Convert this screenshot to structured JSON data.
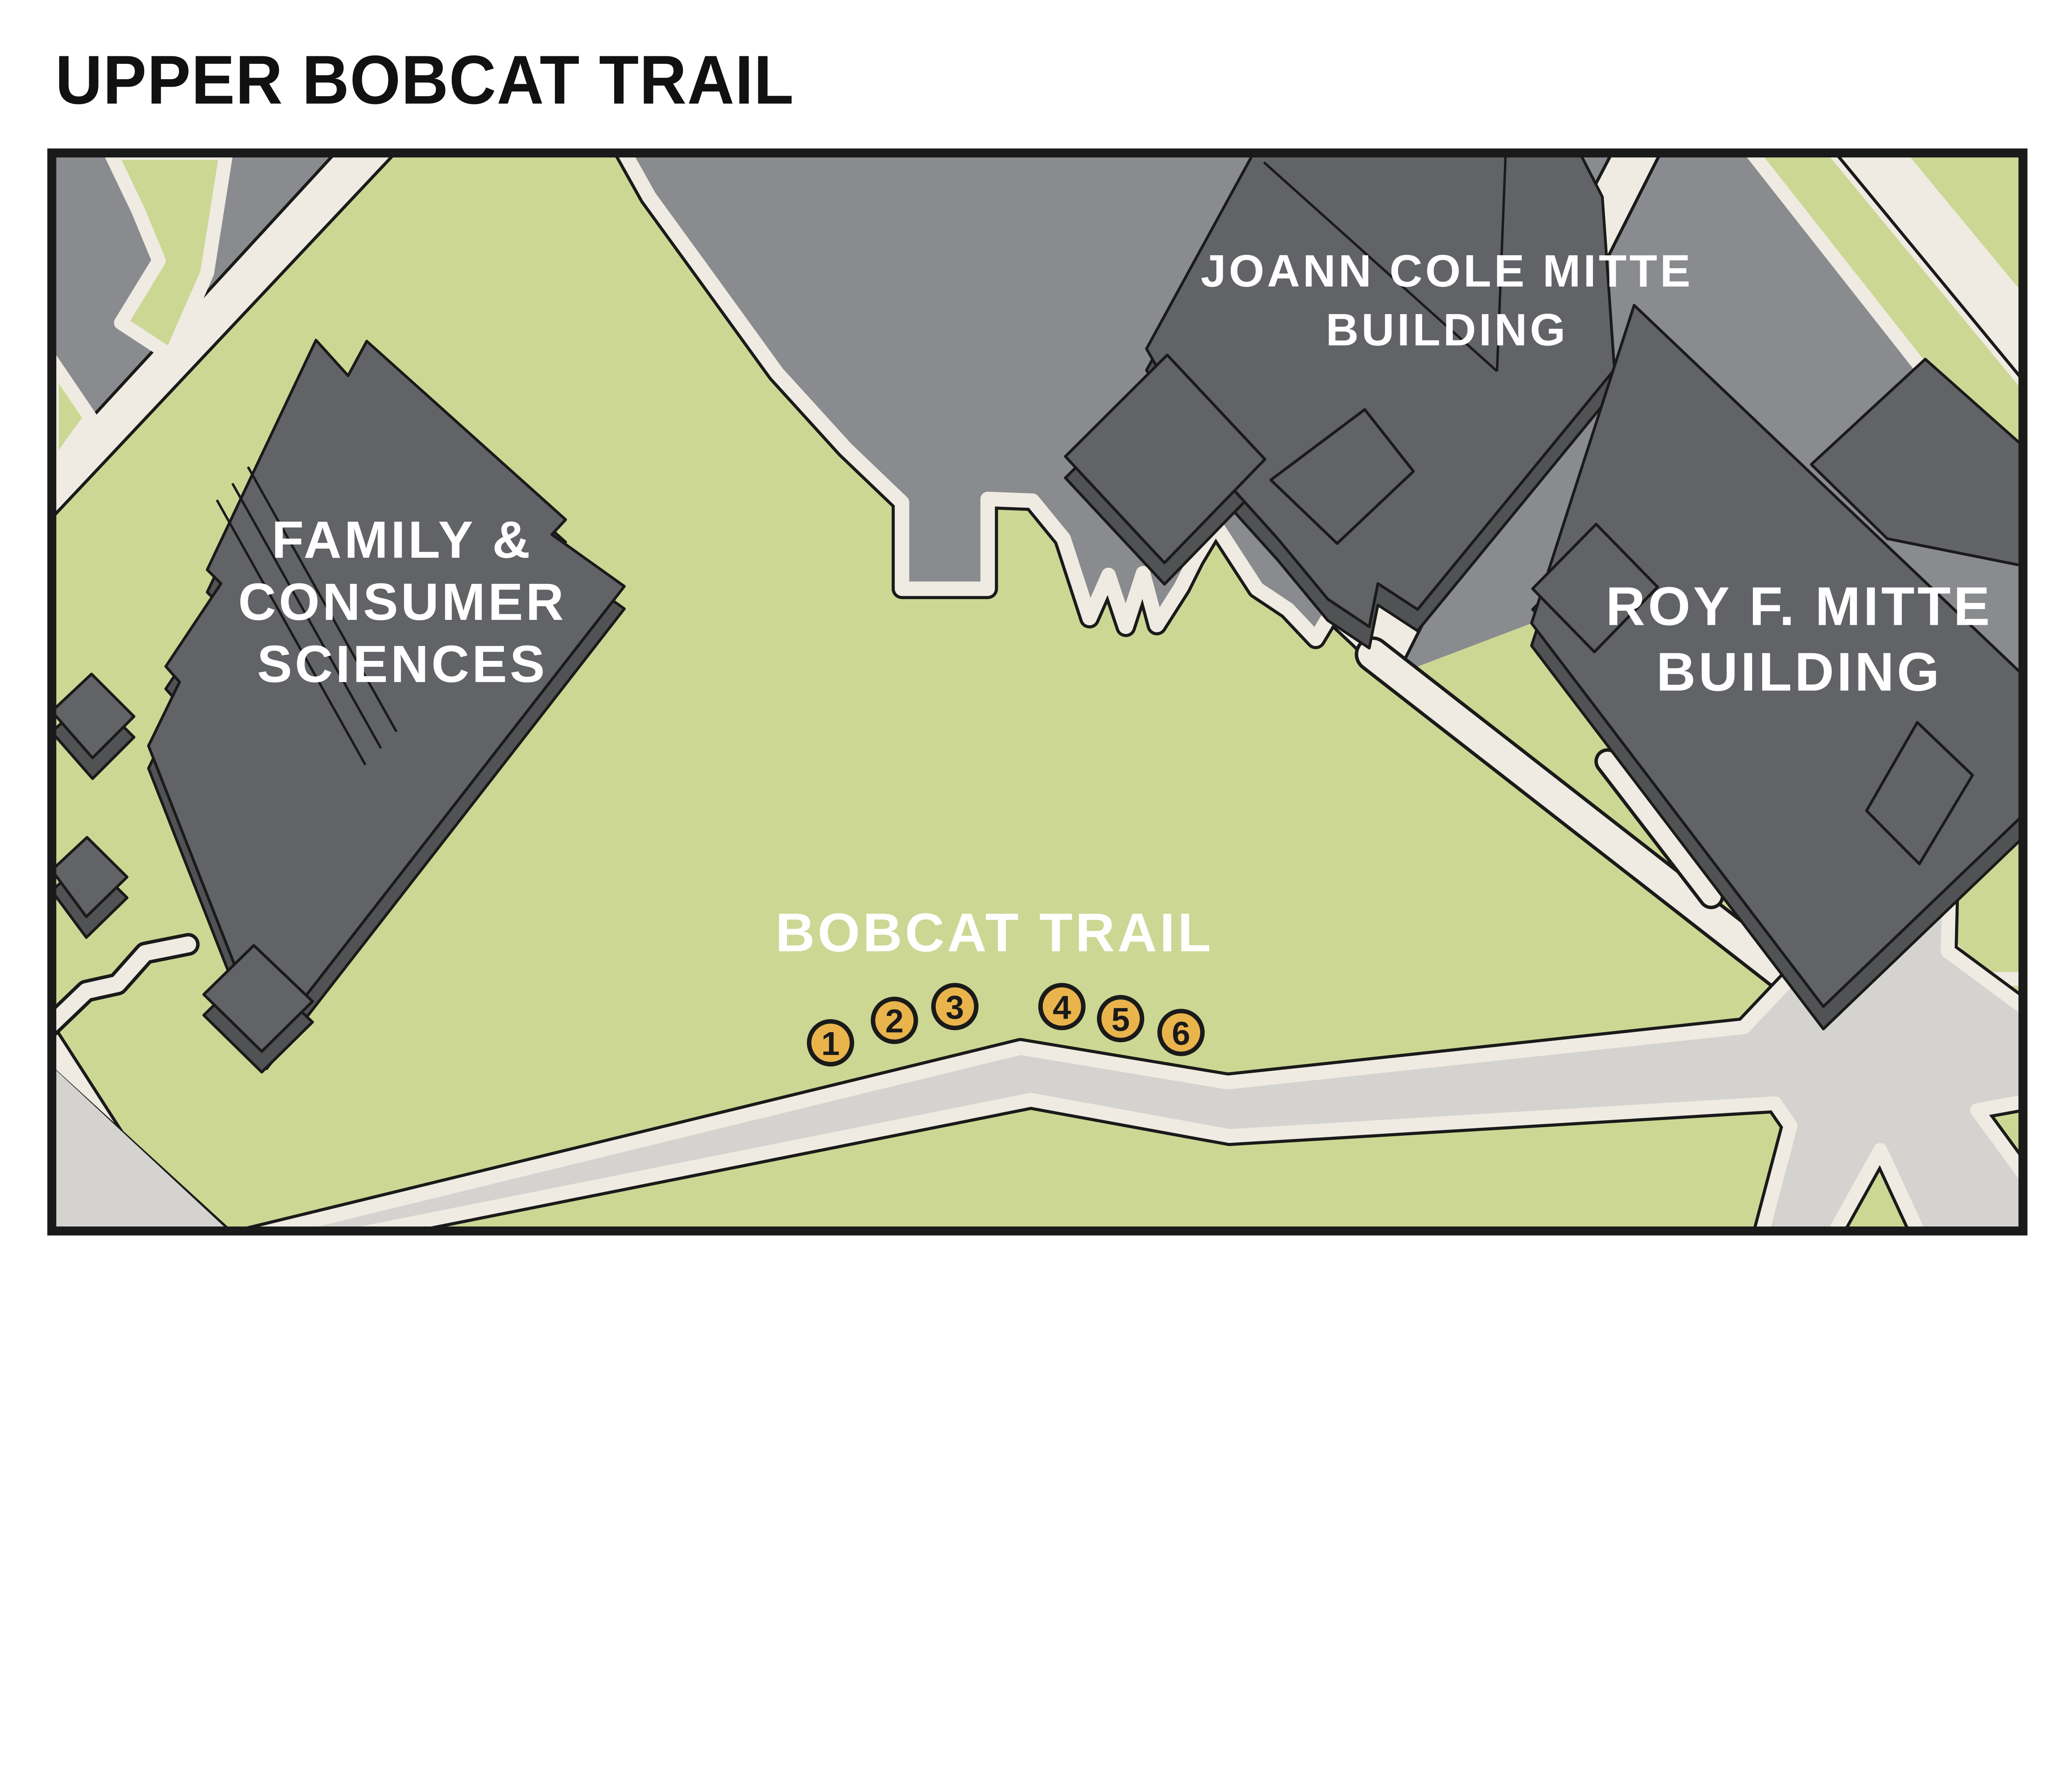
{
  "title": "UPPER BOBCAT TRAIL",
  "colors": {
    "green": "#ccd794",
    "plaza": "#898b8e",
    "road": "#d4d3d0",
    "cream": "#efebe2",
    "bldg": "#626366",
    "bside": "#515254",
    "line": "#1a1a1a",
    "marker": "#e9b44b",
    "label": "#ffffff",
    "title_color": "#111111"
  },
  "buildings": {
    "fcs": {
      "name": "Family & Consumer Sciences Building",
      "lines": [
        "FAMILY &",
        "CONSUMER",
        "SCIENCES"
      ]
    },
    "jcm": {
      "name": "JoAnn Cole Mitte Building",
      "lines": [
        "JOANN COLE MITTE",
        "BUILDING"
      ]
    },
    "rfm": {
      "name": "Roy F. Mitte Building",
      "lines": [
        "ROY F. MITTE",
        "BUILDING"
      ]
    }
  },
  "trail": {
    "label": "BOBCAT TRAIL"
  },
  "markers": [
    {
      "label": "1"
    },
    {
      "label": "2"
    },
    {
      "label": "3"
    },
    {
      "label": "4"
    },
    {
      "label": "5"
    },
    {
      "label": "6"
    }
  ]
}
